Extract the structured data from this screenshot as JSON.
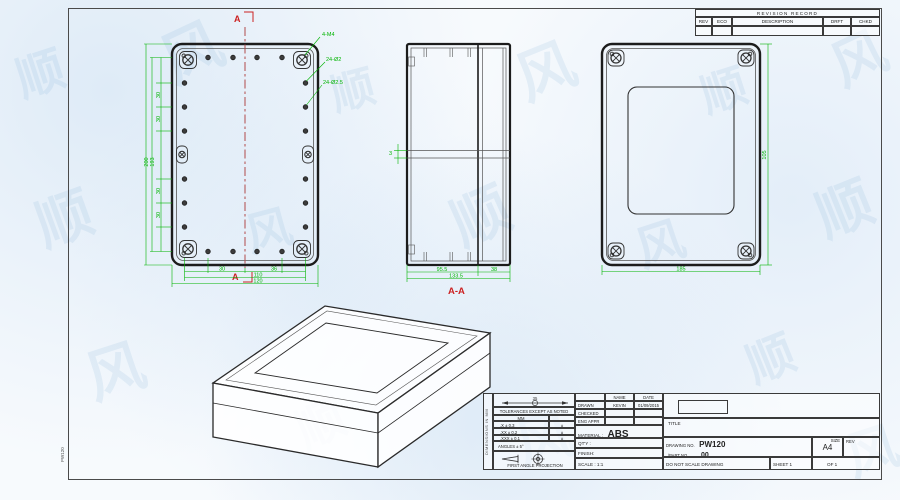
{
  "frame": {
    "side_label": "PW120"
  },
  "watermark": {
    "glyphs": [
      "顺",
      "风"
    ]
  },
  "revision_table": {
    "title": "REVISION RECORD",
    "columns": [
      "REV",
      "ECO",
      "DESCRIPTION",
      "DRFT",
      "CHKD"
    ]
  },
  "front_view": {
    "section_marker": "A",
    "callouts": {
      "corner": "4-M4",
      "holes_small": "24-Ø2",
      "holes_large": "24-Ø2.5"
    },
    "dims": {
      "height_overall": "200",
      "height_holes": "193",
      "pitch_v": "30",
      "pitch_h1": "30",
      "pitch_h2": "36",
      "width_holes": "110",
      "width_overall": "120"
    }
  },
  "section_view": {
    "label": "A-A",
    "dims": {
      "body": "95.5",
      "lid": "38",
      "overall": "133.5",
      "wall": "3"
    }
  },
  "back_view": {
    "dims": {
      "width": "185",
      "height": "105"
    }
  },
  "title_block": {
    "side_note": "DIMENSIONS IN MM",
    "dim_note": "35",
    "tolerance_heading": "TOLERANCES EXCEPT AS NOTED",
    "tolerance_unit": "MM",
    "tolerances": [
      ".X ± 0.3",
      ".XX ± 0.2",
      ".XXX ± 0.1"
    ],
    "tolerance_marks": [
      "±",
      "±",
      "±"
    ],
    "angles": "ANGLES ± 5°",
    "projection": "FIRST ANGLE PROJECTION",
    "name_col": "NAME",
    "date_col": "DATE",
    "sign_rows": [
      {
        "label": "DRAWN",
        "name": "KEVIN",
        "date": "01/09/2015"
      },
      {
        "label": "CHECKED",
        "name": "",
        "date": ""
      },
      {
        "label": "ENG APPR",
        "name": "",
        "date": ""
      }
    ],
    "material_label": "MATERIAL :",
    "material_value": "ABS",
    "qty_label": "QT'Y :",
    "finish_label": "FINISH:",
    "scale_label": "SCALE : 1:1",
    "title_label": "TITLE",
    "drawing_no_label": "DRAWING NO.",
    "drawing_no": "PW120",
    "part_no_label": "/PART NO.",
    "part_no": "00",
    "size_label": "SIZE",
    "size_value": "A4",
    "rev_label": "REV",
    "do_not_scale": "DO NOT SCALE DRAWING",
    "sheet": "SHEET 1",
    "of": "OF 1"
  }
}
